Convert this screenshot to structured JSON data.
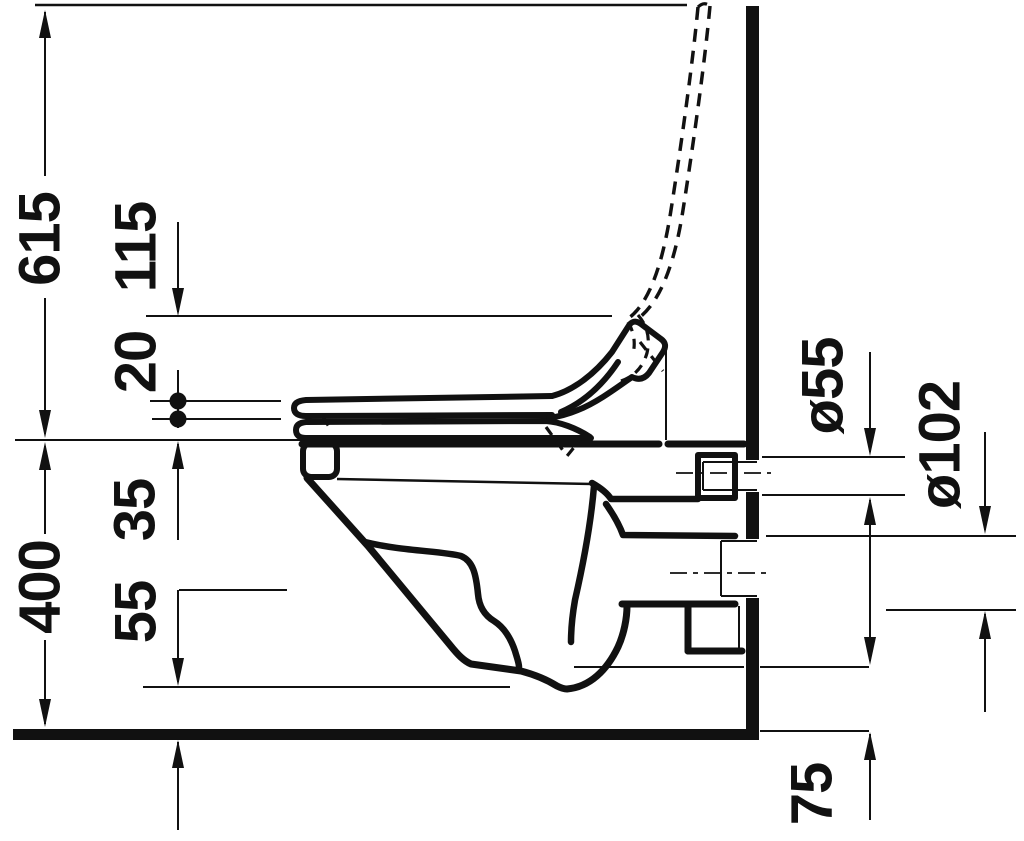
{
  "drawing": {
    "description": "wall-hung-toilet-side-elevation-dimension-drawing",
    "colors": {
      "background": "#ffffff",
      "line": "#111111"
    },
    "dimensions": {
      "total_height_open_lid": "615",
      "lid_rise_above_seat": "115",
      "seat_thickness": "20",
      "rim_to_fixing": "35",
      "rim_height": "400",
      "bowl_bottom_clearance": "55",
      "inlet_diameter": "ø55",
      "outlet_diameter": "ø102",
      "outlet_floor_offset": "75"
    }
  }
}
